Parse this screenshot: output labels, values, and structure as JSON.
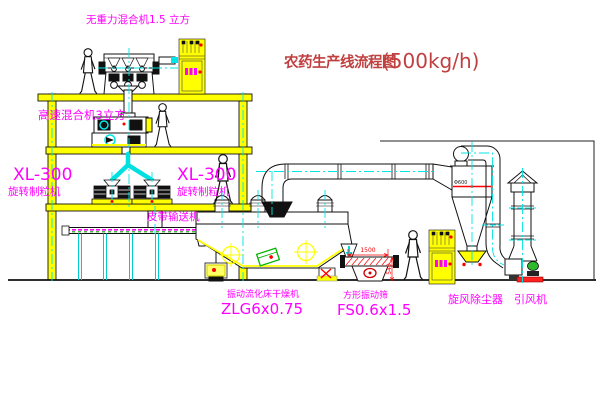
{
  "title": {
    "name": "农药生产线流程图",
    "capacity": "(500kg/h)"
  },
  "equipment_labels": {
    "gravity_free_mixer": "无重力混合机1.5 立方",
    "high_speed_mixer": "高速混合机3立方",
    "granulator_left_model": "XL-300",
    "granulator_left_name": "旋转制粒机",
    "granulator_right_model": "XL-300",
    "granulator_right_name": "旋转制粒机",
    "belt_conveyor": "皮带输送机",
    "fluid_bed_dryer": "振动流化床干燥机",
    "fluid_bed_dryer_model": "ZLG6x0.75",
    "square_vibrating_sieve": "方形振动筛",
    "square_vibrating_sieve_model": "FS0.6x1.5",
    "cyclone_dust_collector": "旋风除尘器",
    "induced_draft_fan": "引风机"
  },
  "dimensions": {
    "sieve_length": "1500",
    "sieve_height": "540",
    "cyclone_diameter": "Φ600"
  },
  "colors": {
    "structure_yellow": "#ffff00",
    "centerline_cyan": "#00e5e5",
    "label_magenta": "#ff00ff",
    "title_red": "#c04040",
    "dimension_red": "#ff0000",
    "motor_green": "#2db82d",
    "ground_black": "#111111"
  }
}
